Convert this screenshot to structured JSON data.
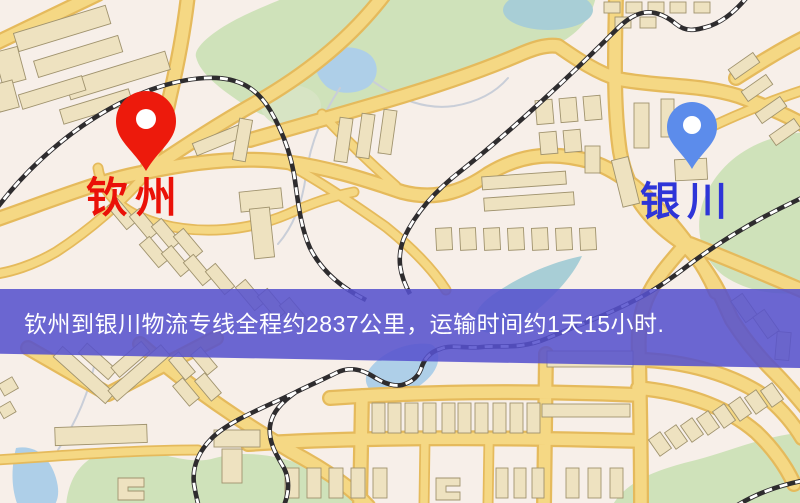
{
  "markers": [
    {
      "name": "qinzhou",
      "label": "钦州"
    },
    {
      "name": "yinchuan",
      "label": "银川"
    }
  ],
  "banner": {
    "text": "钦州到银川物流专线全程约2837公里，运输时间约1天15小时."
  },
  "theme": {
    "map-bg": "#f7efe9",
    "park": "#cfe2ba",
    "park-light": "#d7e4c4",
    "water": "#aecfe8",
    "water-teal": "#a8ced6",
    "stream": "#c9ced8",
    "road-fill": "#f5d884",
    "road-casing": "#e5ba5c",
    "building-fill": "#eee2c0",
    "building-stroke": "#a0936e",
    "rail-dark": "#2e2c2e",
    "rail-light": "#ffffff",
    "banner-bg": "rgba(86,82,206,0.87)",
    "banner-text": "#ffffff",
    "pin-red": "#ed1a0c",
    "pin-red-label": "#ea1108",
    "pin-blue": "#5c8ceb",
    "pin-blue-label": "#2e35d8"
  }
}
